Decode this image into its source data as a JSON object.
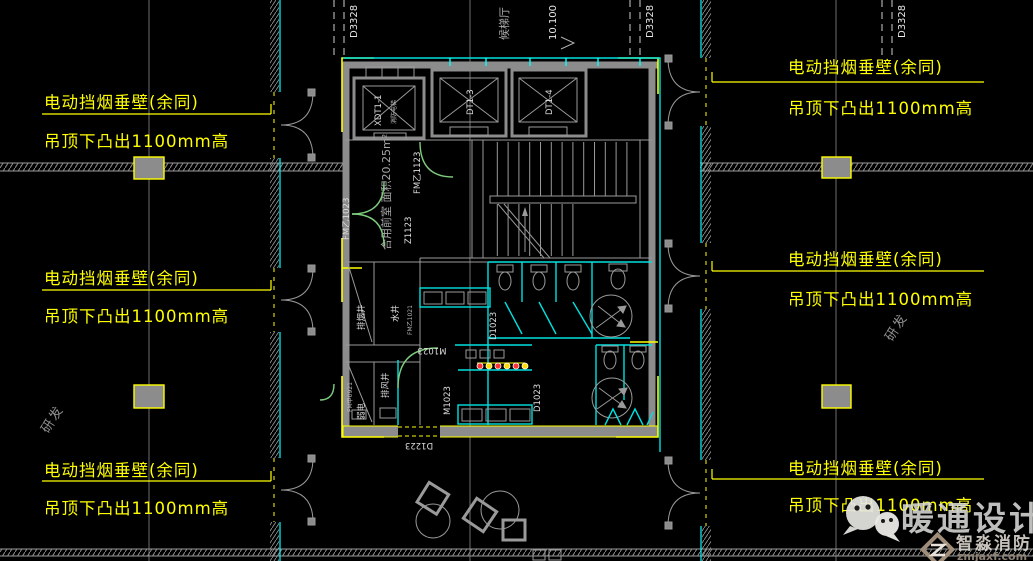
{
  "annotations": {
    "smoke_barrier": "电动挡烟垂壁(余同)",
    "ceiling_drop": "吊顶下凸出1100mm高"
  },
  "grid_labels": {
    "d3328": "D3328",
    "elevator_hall": "候梯厅",
    "level": "10.100",
    "zone": "研发"
  },
  "plan": {
    "elevators": {
      "e1": "XDT1-1",
      "e1_note": "消防电梯",
      "e2": "DT1-3",
      "e3": "DT1-4"
    },
    "rooms": {
      "shared_lobby": "合用前室 面积20.25m²",
      "smoke_shaft": "排烟井",
      "water_shaft": "水井",
      "exhaust_shaft": "排风井",
      "low_voltage": "弱电"
    },
    "doors": {
      "fm_b1023": "FM乙1023",
      "fm_b1123": "FM乙1123",
      "fm_b1021": "FM乙1021",
      "fm_a0921": "FM甲0921",
      "z1123": "Z1123",
      "m1023": "M1023",
      "d1023": "D1023",
      "d1223": "D1223"
    }
  },
  "watermark": {
    "brand": "暖通设计",
    "sub_brand": "智淼消防",
    "url": "zmjaxf.com"
  },
  "colors": {
    "annotation_yellow": "#ffff00",
    "partition_cyan": "#00e0e0",
    "door_green": "#7ecb7e",
    "line_gray": "#9a9a9a",
    "text_white": "#e8e8e8",
    "column_fill": "#8c8c8c",
    "urinal_red": "#ff3333"
  }
}
